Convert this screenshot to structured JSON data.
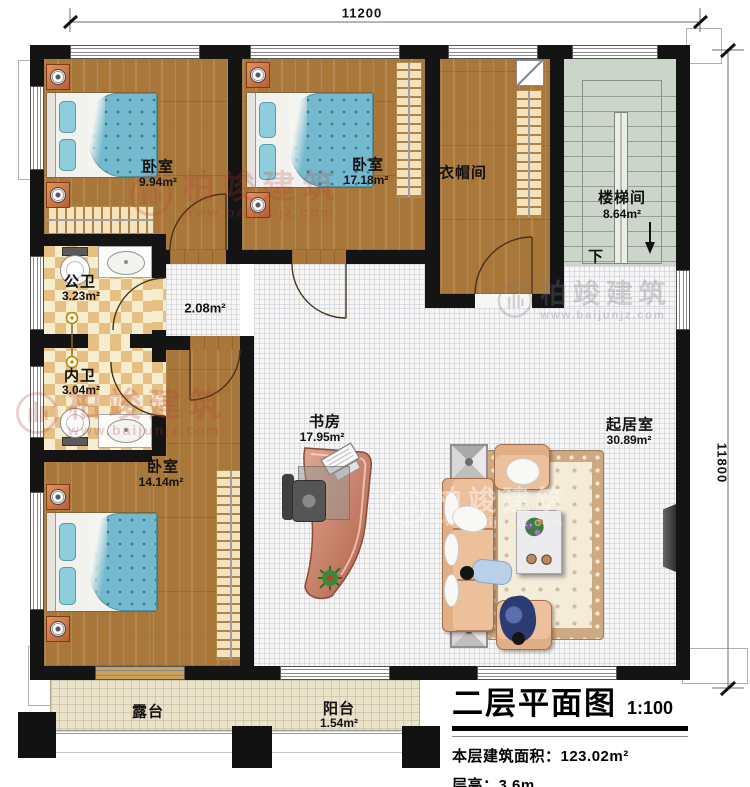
{
  "dimensions": {
    "top": "11200",
    "right": "11800"
  },
  "watermark": {
    "name": "柏竣建筑",
    "url": "www.baijunjz.com"
  },
  "rooms": {
    "bedroom1": {
      "name": "卧室",
      "area": "9.94m²"
    },
    "bedroom2": {
      "name": "卧室",
      "area": "17.18m²"
    },
    "cloakroom": {
      "name": "衣帽间"
    },
    "stairwell": {
      "name": "楼梯间",
      "area": "8.64m²",
      "down_label": "下"
    },
    "public_bath": {
      "name": "公卫",
      "area": "3.23m²"
    },
    "private_bath": {
      "name": "内卫",
      "area": "3.04m²"
    },
    "hallway": {
      "area": "2.08m²"
    },
    "bedroom3": {
      "name": "卧室",
      "area": "14.14m²"
    },
    "study": {
      "name": "书房",
      "area": "17.95m²"
    },
    "living": {
      "name": "起居室",
      "area": "30.89m²"
    },
    "terrace": {
      "name": "露台"
    },
    "balcony": {
      "name": "阳台",
      "area": "1.54m²"
    }
  },
  "title_block": {
    "title": "二层平面图",
    "scale": "1:100",
    "floor_area": "本层建筑面积：123.02m²",
    "floor_height": "层高：3.6m"
  },
  "colors": {
    "wall": "#141414",
    "wood_floor": "#a9773a",
    "stair_floor": "#ccd5c9",
    "bath_tile": "#e6c083",
    "duvet": "#74b9ce",
    "sofa": "#edc09c",
    "desk": "#c3785f",
    "watermark_red": "#b5453c"
  }
}
